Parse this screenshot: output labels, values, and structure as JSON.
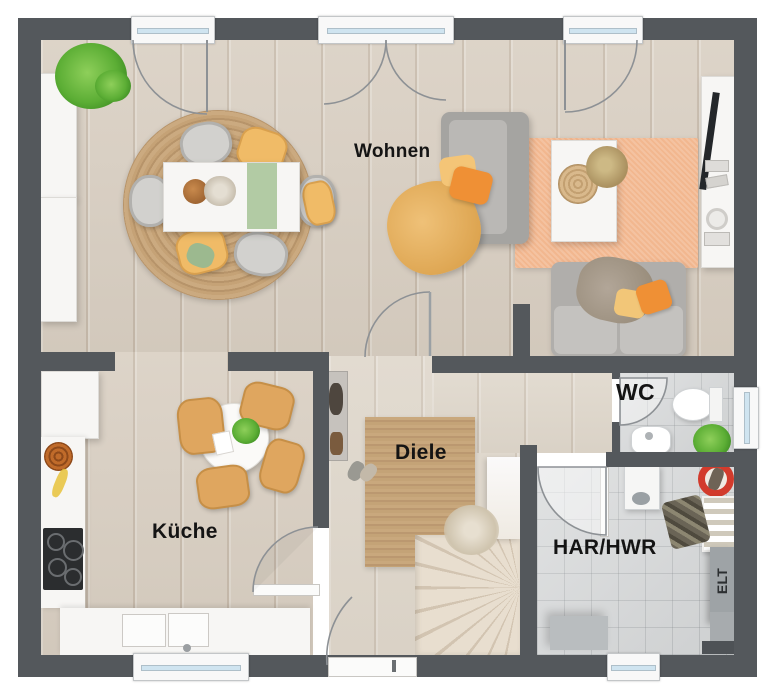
{
  "title": "Erdgeschoss Grundriss",
  "rooms": {
    "wohnen": {
      "label": "Wohnen"
    },
    "kueche": {
      "label": "Küche"
    },
    "diele": {
      "label": "Diele"
    },
    "wc": {
      "label": "WC"
    },
    "har": {
      "label": "HAR/HWR"
    },
    "elt": {
      "label": "ELT"
    }
  },
  "colors": {
    "wall": "#54585c",
    "wood_floor": "#d9cfc2",
    "diele_floor": "#ded6ca",
    "tile_floor": "#d6d8d9",
    "rug_jute": "#c2a176",
    "rug_orange": "#f2b78f",
    "sofa_gray": "#aaa9a6",
    "chair_yellow": "#f0bb67",
    "chair_wood": "#dfa65f",
    "accent_orange": "#ef9035",
    "accent_green": "#a9c99c",
    "plant_green": "#5cae35",
    "bucket_red": "#d23b2c",
    "window_glass": "#cfe4f0",
    "elt_panel": "#9ea3a6"
  }
}
